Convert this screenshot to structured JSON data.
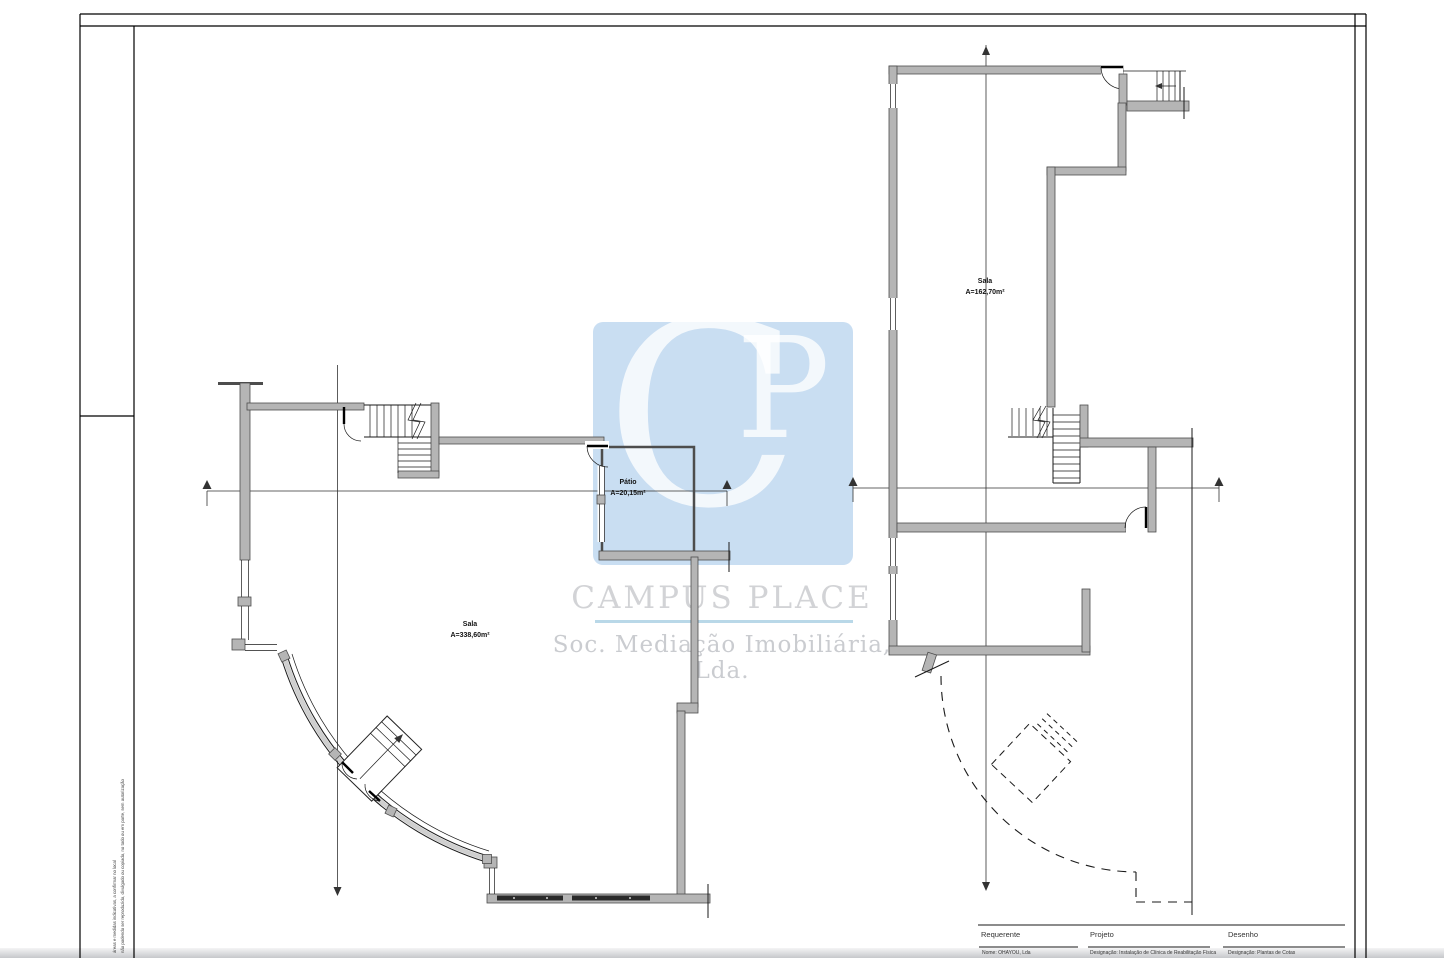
{
  "watermark": {
    "letter_c": "C",
    "letter_p": "P",
    "company": "CAMPUS PLACE",
    "subtitle": "Soc. Mediação Imobiliária, Lda.",
    "square_color": "#c9def2",
    "company_color": "#d2d3d6",
    "rule_color": "#b9d8e8",
    "subtitle_color": "#caccd0"
  },
  "rooms": {
    "left_sala": {
      "name": "Sala",
      "area": "A=338,60m²"
    },
    "patio": {
      "name": "Pátio",
      "area": "A=20,15m²"
    },
    "right_sala": {
      "name": "Sala",
      "area": "A=162,70m²"
    }
  },
  "title_block": {
    "requerente": {
      "label": "Requerente",
      "value": "Nome: OHAYOU, Lda"
    },
    "projeto": {
      "label": "Projeto",
      "value": "Designação: Instalação  de Clínica de Reabilitação Física"
    },
    "desenho": {
      "label": "Desenho",
      "value": "Designação: Plantas de Cotas"
    }
  },
  "margin_note": {
    "line1": "áreas e medidas indicativas, a confirmar no local",
    "line2": "não podendo ser reproduzido, divulgado ou copiado, no todo ou em parte, sem autorização"
  },
  "drawing_colors": {
    "wall_fill": "#b5b5b5",
    "wall_edge": "#4d4d4d",
    "line": "#1a1a1a"
  }
}
